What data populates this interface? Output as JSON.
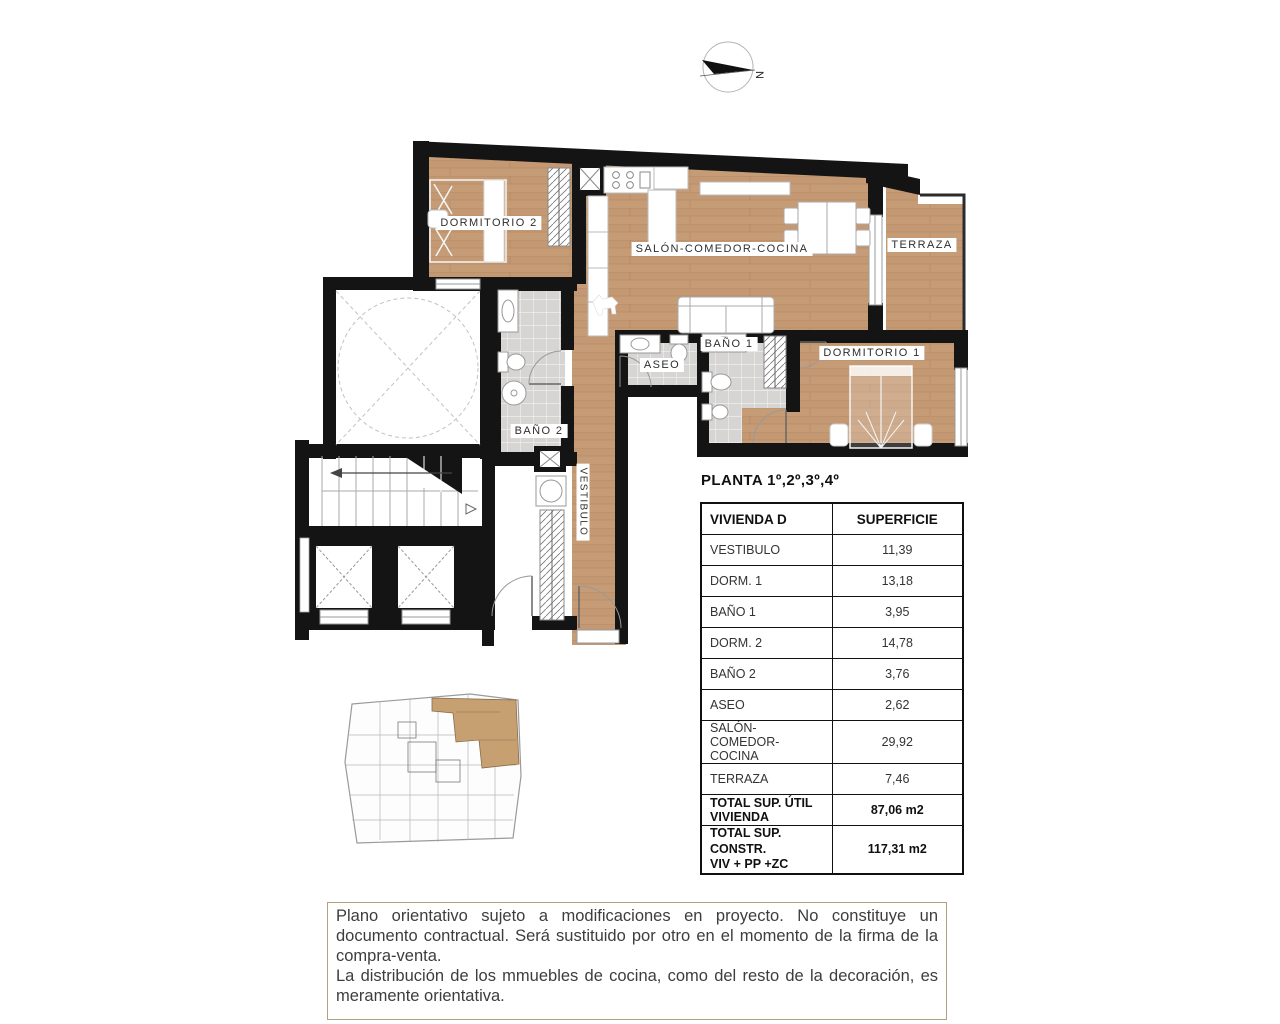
{
  "compass": {
    "label": "N"
  },
  "plan": {
    "rooms": [
      {
        "id": "dormitorio2",
        "label": "DORMITORIO 2"
      },
      {
        "id": "salon",
        "label": "SALÓN-COMEDOR-COCINA"
      },
      {
        "id": "terraza",
        "label": "TERRAZA"
      },
      {
        "id": "dormitorio1",
        "label": "DORMITORIO 1"
      },
      {
        "id": "bano1",
        "label": "BAÑO 1"
      },
      {
        "id": "aseo",
        "label": "ASEO"
      },
      {
        "id": "bano2",
        "label": "BAÑO 2"
      },
      {
        "id": "vestibulo",
        "label": "VESTIBULO"
      }
    ],
    "colors": {
      "wood": "#c69c77",
      "tile": "#d6d5d3",
      "wall": "#141414",
      "highlight": "#c7a072"
    }
  },
  "table": {
    "title": "PLANTA 1º,2º,3º,4º",
    "headers": [
      "VIVIENDA D",
      "SUPERFICIE"
    ],
    "rows": [
      [
        "VESTIBULO",
        "11,39"
      ],
      [
        "DORM. 1",
        "13,18"
      ],
      [
        "BAÑO 1",
        "3,95"
      ],
      [
        "DORM. 2",
        "14,78"
      ],
      [
        "BAÑO 2",
        "3,76"
      ],
      [
        "ASEO",
        "2,62"
      ],
      [
        "SALÓN-COMEDOR-COCINA",
        "29,92"
      ],
      [
        "TERRAZA",
        "7,46"
      ]
    ],
    "total_util": {
      "label": "TOTAL SUP. ÚTIL VIVIENDA",
      "value": "87,06 m2"
    },
    "total_constr": {
      "label_line1": "TOTAL SUP. CONSTR.",
      "label_line2": "VIV + PP +ZC",
      "value": "117,31 m2"
    }
  },
  "disclaimer": {
    "paragraph1": "Plano orientativo sujeto a modificaciones en proyecto. No constituye un documento contractual. Será sustituido por otro en el momento de la firma de la compra-venta.",
    "paragraph2": "La distribución de los mmuebles de cocina, como del resto de la decoración, es meramente orientativa."
  }
}
